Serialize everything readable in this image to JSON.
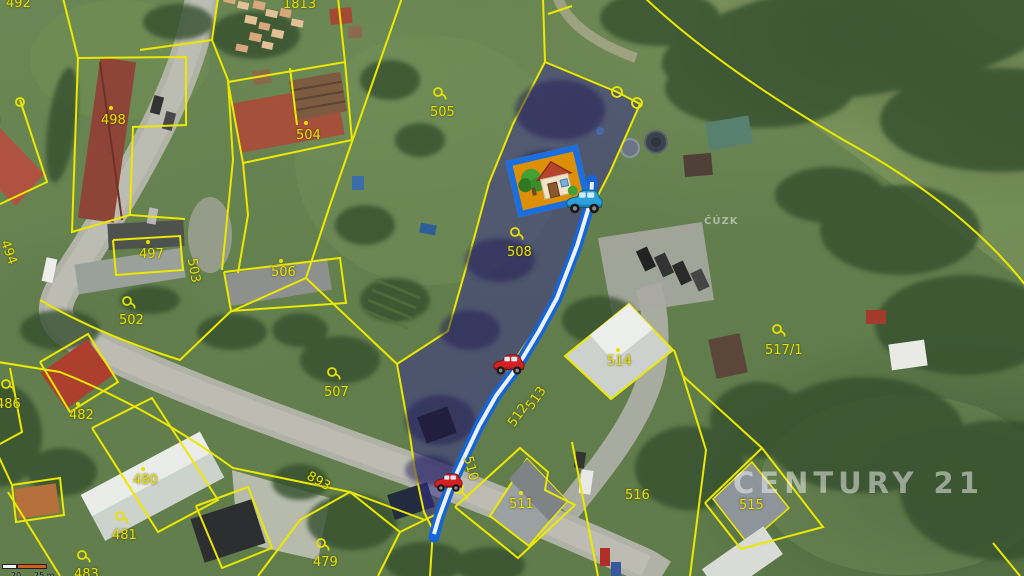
{
  "map": {
    "agency_watermark": "CENTURY 21",
    "source_watermark": "ČÚZK",
    "scale_bar": {
      "mid_label": "20",
      "end_label": "25 m"
    },
    "colors": {
      "cadastral_line": "#ece800",
      "parcel_highlight_fill": "#3a308c",
      "route_blue": "#1565d8",
      "house_marker_bg": "#dd8f07",
      "house_marker_border": "#1a6fe0",
      "car_red": "#d42222",
      "car_blue": "#2aa0dc"
    },
    "highlighted_parcel": "508",
    "parcel_labels": [
      {
        "text": "492",
        "x": 6,
        "y": -3,
        "rot": 0,
        "marker": "none"
      },
      {
        "text": "1813",
        "x": 283,
        "y": -2,
        "rot": 0,
        "marker": "none"
      },
      {
        "text": "0",
        "x": -8,
        "y": 115,
        "rot": 0,
        "marker": "none"
      },
      {
        "text": "498",
        "x": 101,
        "y": 114,
        "rot": 0,
        "marker": "dot",
        "mx": 109,
        "my": 106
      },
      {
        "text": "504",
        "x": 296,
        "y": 129,
        "rot": 0,
        "marker": "dot",
        "mx": 304,
        "my": 121
      },
      {
        "text": "505",
        "x": 430,
        "y": 106,
        "rot": 0,
        "marker": "ring",
        "mx": 432,
        "my": 86
      },
      {
        "text": "508",
        "x": 507,
        "y": 246,
        "rot": 0,
        "marker": "ring",
        "mx": 509,
        "my": 226
      },
      {
        "text": "494",
        "x": -4,
        "y": 246,
        "rot": 70,
        "marker": "none"
      },
      {
        "text": "497",
        "x": 139,
        "y": 248,
        "rot": 0,
        "marker": "dot",
        "mx": 146,
        "my": 240
      },
      {
        "text": "503",
        "x": 181,
        "y": 264,
        "rot": 80,
        "marker": "none"
      },
      {
        "text": "506",
        "x": 271,
        "y": 266,
        "rot": 0,
        "marker": "dot",
        "mx": 279,
        "my": 259
      },
      {
        "text": "502",
        "x": 119,
        "y": 314,
        "rot": 0,
        "marker": "ring",
        "mx": 121,
        "my": 295
      },
      {
        "text": "486",
        "x": -4,
        "y": 398,
        "rot": 0,
        "marker": "ring",
        "mx": 0,
        "my": 378
      },
      {
        "text": "482",
        "x": 69,
        "y": 409,
        "rot": 0,
        "marker": "dot",
        "mx": 76,
        "my": 402
      },
      {
        "text": "507",
        "x": 324,
        "y": 386,
        "rot": 0,
        "marker": "ring",
        "mx": 326,
        "my": 366
      },
      {
        "text": "893",
        "x": 306,
        "y": 475,
        "rot": 30,
        "marker": "none"
      },
      {
        "text": "480",
        "x": 133,
        "y": 474,
        "rot": 0,
        "marker": "dot",
        "mx": 141,
        "my": 467
      },
      {
        "text": "481",
        "x": 112,
        "y": 529,
        "rot": 0,
        "marker": "ring",
        "mx": 114,
        "my": 510
      },
      {
        "text": "483",
        "x": 74,
        "y": 568,
        "rot": 0,
        "marker": "ring",
        "mx": 76,
        "my": 549
      },
      {
        "text": "479",
        "x": 313,
        "y": 556,
        "rot": 0,
        "marker": "ring",
        "mx": 315,
        "my": 537
      },
      {
        "text": "513",
        "x": 524,
        "y": 392,
        "rot": -55,
        "marker": "none"
      },
      {
        "text": "512",
        "x": 506,
        "y": 409,
        "rot": -55,
        "marker": "none"
      },
      {
        "text": "510",
        "x": 458,
        "y": 462,
        "rot": 75,
        "marker": "none"
      },
      {
        "text": "511",
        "x": 509,
        "y": 498,
        "rot": 0,
        "marker": "dot",
        "mx": 519,
        "my": 491
      },
      {
        "text": "514",
        "x": 607,
        "y": 355,
        "rot": 0,
        "marker": "dot",
        "mx": 616,
        "my": 348
      },
      {
        "text": "516",
        "x": 625,
        "y": 489,
        "rot": 0,
        "marker": "none"
      },
      {
        "text": "515",
        "x": 739,
        "y": 499,
        "rot": 0,
        "marker": "none"
      },
      {
        "text": "517/1",
        "x": 765,
        "y": 344,
        "rot": 0,
        "marker": "ring",
        "mx": 771,
        "my": 323
      }
    ]
  }
}
